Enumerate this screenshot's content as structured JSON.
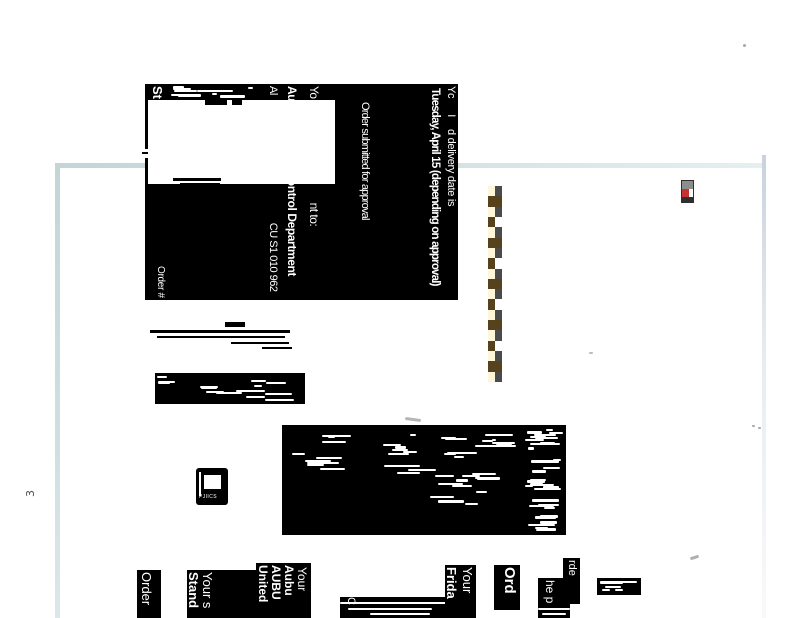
{
  "page": {
    "number": "3"
  },
  "hdr": {
    "yc": "Yc",
    "sep": "I",
    "delivery_intro": "d delivery date is",
    "delivery_date": "Tuesday, April 15 (depending on approval)",
    "status": "Order submitted for approval",
    "yo": "Yo",
    "nt_to": "nt to:",
    "au": "Au",
    "dept": "tion Control Department",
    "al": "Al",
    "addr": "CU S1 010 962",
    "st": "St",
    "order_label": "Order #"
  },
  "footer": {
    "order": "Order",
    "your_s": "Your s",
    "stand": "Stand",
    "your_a": "Your",
    "aubu": "Aubu",
    "aubu_caps": "AUBU",
    "united": "United",
    "c": "C",
    "your_b": "Your",
    "frida": "Frida",
    "ord": "Ord",
    "he_p": "he p",
    "rde": "rde"
  },
  "logo": {
    "glyphs": "PJIICS"
  },
  "colors": {
    "page_edge": "#c2d5d7",
    "block_bg": "#000000",
    "text_on_block": "#ffffff",
    "checker_cream": "#fdf6d8",
    "checker_olive": "#56431d",
    "checker_gray": "#4b4b4b",
    "checker_white": "#ffffff",
    "icon_red": "#c63230",
    "icon_gray": "#8d8d8d",
    "icon_dark": "#2f2f2f",
    "page_number_color": "#4f4f4f"
  },
  "checker": {
    "rows": 19,
    "cols": 2
  }
}
